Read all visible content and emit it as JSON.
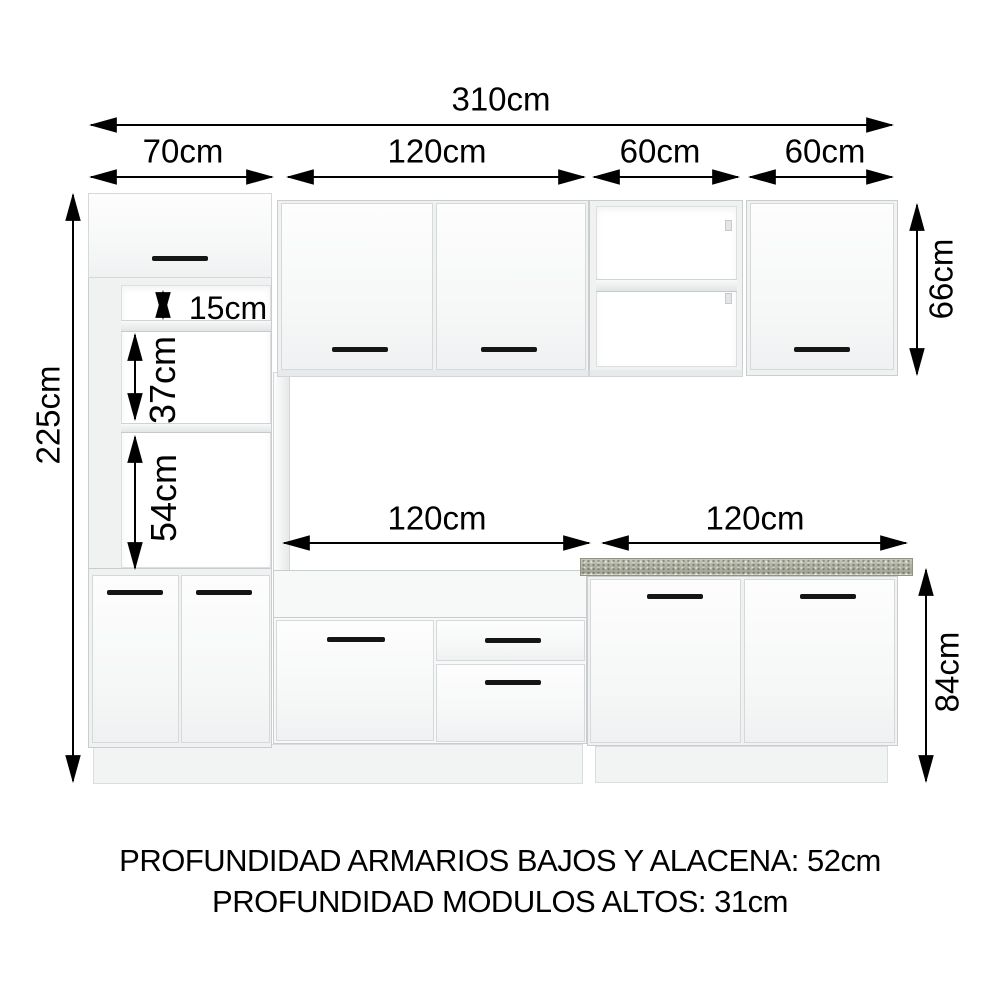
{
  "dims": {
    "total_width": "310cm",
    "tower_width": "70cm",
    "upper_mid_width": "120cm",
    "upper_open_width": "60cm",
    "upper_right_width": "60cm",
    "total_height": "225cm",
    "upper_modules_height": "66cm",
    "tower_top_gap": "15cm",
    "tower_mid_niche": "37cm",
    "tower_bottom_niche": "54cm",
    "base_mid_width": "120cm",
    "base_right_width": "120cm",
    "base_height": "84cm"
  },
  "footer": {
    "line1": "PROFUNDIDAD ARMARIOS BAJOS Y ALACENA: 52cm",
    "line2": "PROFUNDIDAD MODULOS ALTOS: 31cm"
  },
  "colors": {
    "dimension_text": "#000000",
    "cabinet_border": "#c9cdcf",
    "countertop": "#a9ac9d",
    "handle": "#151515"
  }
}
